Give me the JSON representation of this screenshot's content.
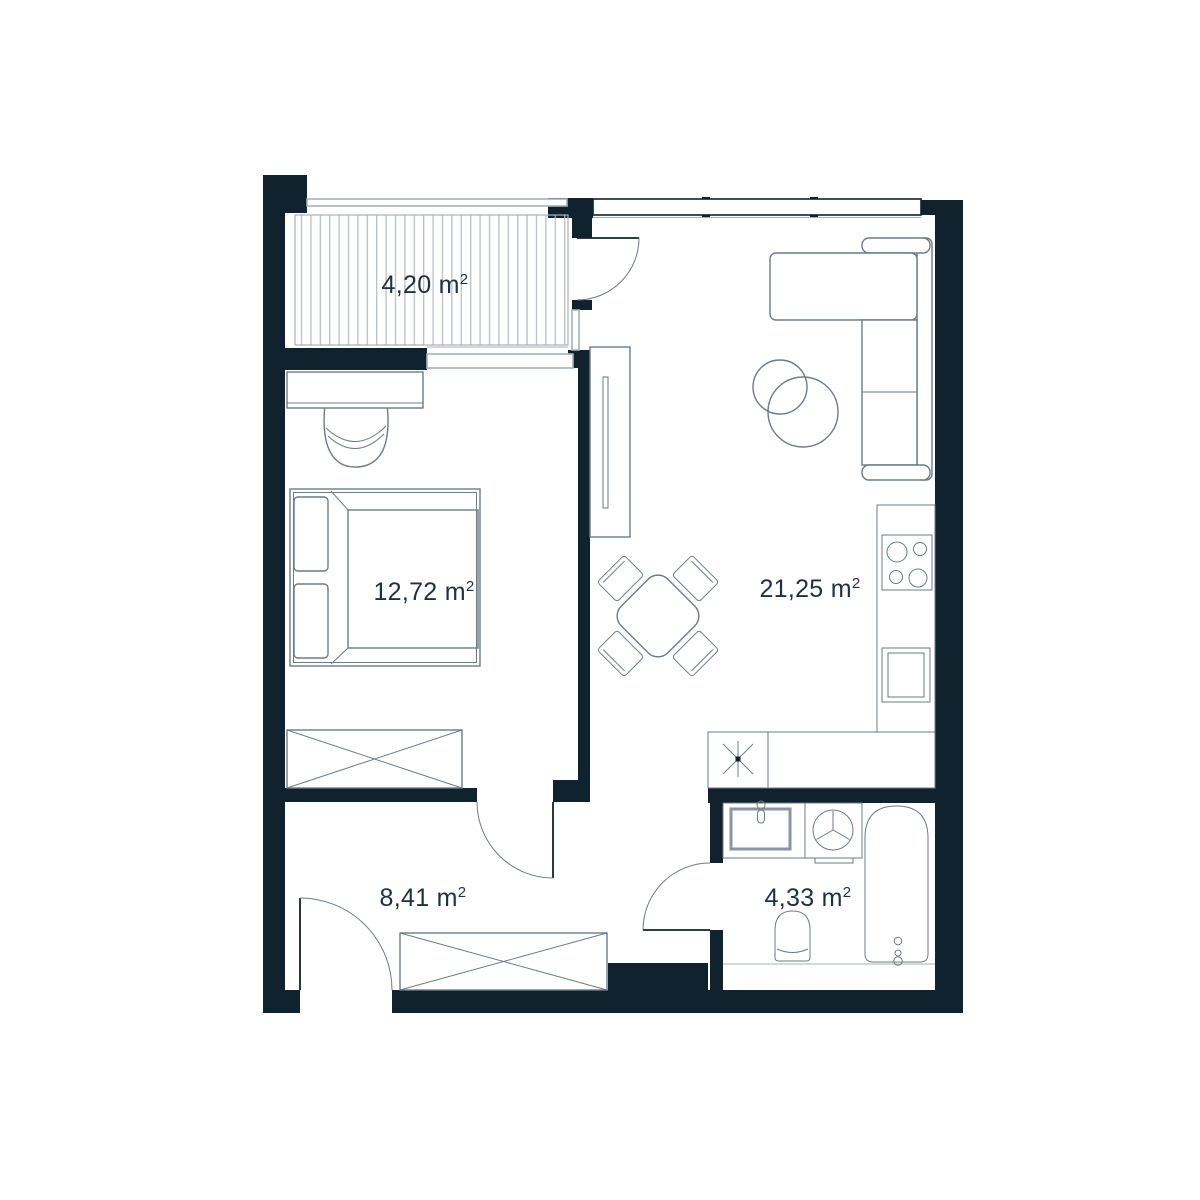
{
  "document": {
    "kind": "apartment floor plan"
  },
  "colors": {
    "background": "#ffffff",
    "wall": "#11222f",
    "furniture_line": "#6d7a87",
    "light_line": "#a8b1b9",
    "stripe": "#b3bac1",
    "text": "#1f3040"
  },
  "rooms": {
    "balcony": {
      "area_label": "4,20 m",
      "area_sup": "2",
      "area_text": "4,20 m²"
    },
    "bedroom": {
      "area_label": "12,72 m",
      "area_sup": "2",
      "area_text": "12,72 m²"
    },
    "living_room_kitchen": {
      "area_label": "21,25 m",
      "area_sup": "2",
      "area_text": "21,25 m²"
    },
    "hallway": {
      "area_label": "8,41 m",
      "area_sup": "2",
      "area_text": "8,41 m²"
    },
    "bathroom": {
      "area_label": "4,33 m",
      "area_sup": "2",
      "area_text": "4,33 m²"
    }
  },
  "fixtures": {
    "balcony": [
      "decking",
      "railing",
      "balcony-door"
    ],
    "bedroom": [
      "desk",
      "desk-chair",
      "double-bed",
      "wardrobe",
      "window",
      "door"
    ],
    "living_room_kitchen": [
      "shelf",
      "dining-table",
      "dining-chairs",
      "corner-sofa",
      "coffee-table",
      "kitchen-counter",
      "hob",
      "kitchen-sink",
      "boiler-symbol",
      "windows"
    ],
    "hallway": [
      "wardrobe",
      "entrance-door"
    ],
    "bathroom": [
      "washbasin",
      "washing-machine",
      "bathtub",
      "toilet",
      "door"
    ]
  }
}
